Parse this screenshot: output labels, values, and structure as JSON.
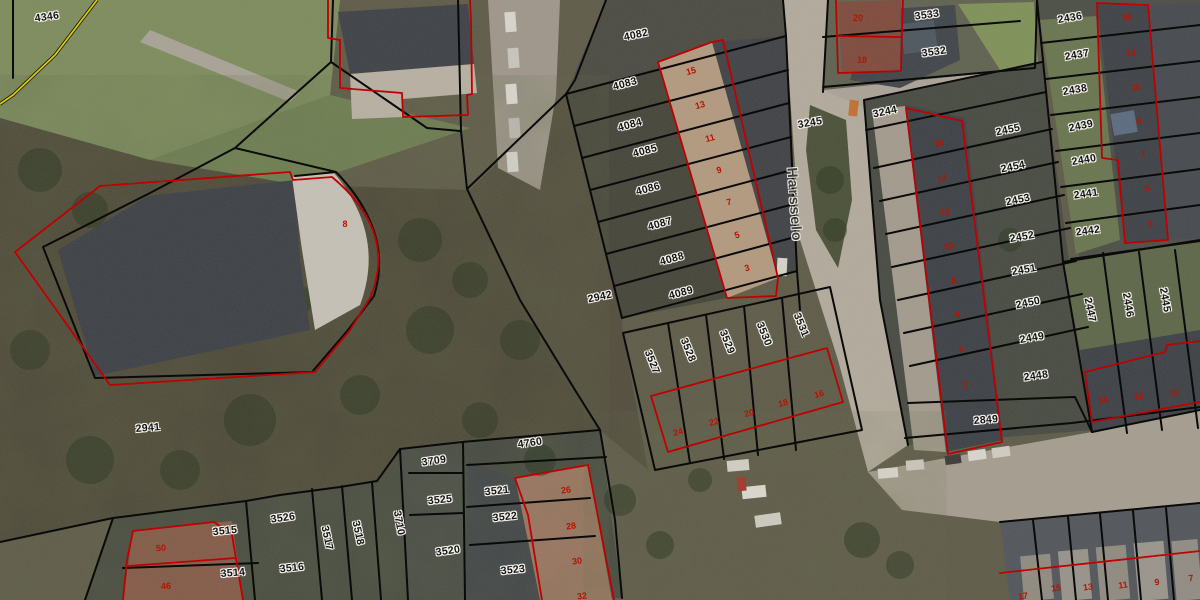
{
  "map": {
    "street_labels": [
      {
        "t": "Harsselo",
        "x": 795,
        "y": 205,
        "r": 86
      }
    ],
    "parcel_labels": [
      {
        "t": "4346",
        "x": 47,
        "y": 17,
        "r": -8
      },
      {
        "t": "4082",
        "x": 636,
        "y": 35,
        "r": -12
      },
      {
        "t": "4083",
        "x": 625,
        "y": 84,
        "r": -15
      },
      {
        "t": "4084",
        "x": 630,
        "y": 125,
        "r": -15
      },
      {
        "t": "4085",
        "x": 645,
        "y": 151,
        "r": -15
      },
      {
        "t": "4086",
        "x": 648,
        "y": 189,
        "r": -15
      },
      {
        "t": "4087",
        "x": 660,
        "y": 224,
        "r": -15
      },
      {
        "t": "4088",
        "x": 672,
        "y": 259,
        "r": -15
      },
      {
        "t": "4089",
        "x": 681,
        "y": 293,
        "r": -15
      },
      {
        "t": "2942",
        "x": 600,
        "y": 297,
        "r": -12
      },
      {
        "t": "2941",
        "x": 148,
        "y": 428,
        "r": -5
      },
      {
        "t": "3245",
        "x": 810,
        "y": 123,
        "r": -10
      },
      {
        "t": "3244",
        "x": 885,
        "y": 112,
        "r": -12
      },
      {
        "t": "3533",
        "x": 927,
        "y": 15,
        "r": -8
      },
      {
        "t": "3532",
        "x": 934,
        "y": 52,
        "r": -8
      },
      {
        "t": "2436",
        "x": 1070,
        "y": 18,
        "r": -10
      },
      {
        "t": "2437",
        "x": 1077,
        "y": 55,
        "r": -10
      },
      {
        "t": "2438",
        "x": 1075,
        "y": 90,
        "r": -10
      },
      {
        "t": "2439",
        "x": 1081,
        "y": 126,
        "r": -12
      },
      {
        "t": "2440",
        "x": 1084,
        "y": 160,
        "r": -10
      },
      {
        "t": "2441",
        "x": 1086,
        "y": 194,
        "r": -8
      },
      {
        "t": "2442",
        "x": 1088,
        "y": 231,
        "r": -8
      },
      {
        "t": "2455",
        "x": 1008,
        "y": 130,
        "r": -12
      },
      {
        "t": "2454",
        "x": 1013,
        "y": 167,
        "r": -12
      },
      {
        "t": "2453",
        "x": 1018,
        "y": 200,
        "r": -12
      },
      {
        "t": "2452",
        "x": 1022,
        "y": 237,
        "r": -10
      },
      {
        "t": "2451",
        "x": 1024,
        "y": 270,
        "r": -10
      },
      {
        "t": "2450",
        "x": 1028,
        "y": 303,
        "r": -12
      },
      {
        "t": "2449",
        "x": 1032,
        "y": 338,
        "r": -10
      },
      {
        "t": "2448",
        "x": 1036,
        "y": 376,
        "r": -8
      },
      {
        "t": "2849",
        "x": 986,
        "y": 420,
        "r": -5
      },
      {
        "t": "2447",
        "x": 1090,
        "y": 310,
        "r": 78
      },
      {
        "t": "2446",
        "x": 1128,
        "y": 305,
        "r": 80
      },
      {
        "t": "2445",
        "x": 1165,
        "y": 300,
        "r": 80
      },
      {
        "t": "3527",
        "x": 652,
        "y": 362,
        "r": 68
      },
      {
        "t": "3528",
        "x": 688,
        "y": 350,
        "r": 68
      },
      {
        "t": "3529",
        "x": 727,
        "y": 342,
        "r": 68
      },
      {
        "t": "3530",
        "x": 764,
        "y": 334,
        "r": 68
      },
      {
        "t": "3531",
        "x": 801,
        "y": 325,
        "r": 68
      },
      {
        "t": "4760",
        "x": 530,
        "y": 443,
        "r": -8
      },
      {
        "t": "3709",
        "x": 434,
        "y": 461,
        "r": -8
      },
      {
        "t": "3525",
        "x": 440,
        "y": 500,
        "r": -6
      },
      {
        "t": "3521",
        "x": 497,
        "y": 491,
        "r": -6
      },
      {
        "t": "3522",
        "x": 505,
        "y": 517,
        "r": -6
      },
      {
        "t": "3520",
        "x": 448,
        "y": 551,
        "r": -8
      },
      {
        "t": "3523",
        "x": 513,
        "y": 570,
        "r": -6
      },
      {
        "t": "3526",
        "x": 283,
        "y": 518,
        "r": -8
      },
      {
        "t": "3515",
        "x": 225,
        "y": 531,
        "r": -6
      },
      {
        "t": "3514",
        "x": 233,
        "y": 573,
        "r": -5
      },
      {
        "t": "3516",
        "x": 292,
        "y": 568,
        "r": -6
      },
      {
        "t": "3517",
        "x": 327,
        "y": 538,
        "r": 78
      },
      {
        "t": "3518",
        "x": 358,
        "y": 533,
        "r": 78
      },
      {
        "t": "3710",
        "x": 399,
        "y": 523,
        "r": 80
      }
    ],
    "house_number_labels": [
      {
        "t": "15",
        "x": 691,
        "y": 71,
        "r": -15
      },
      {
        "t": "13",
        "x": 700,
        "y": 105,
        "r": -15
      },
      {
        "t": "11",
        "x": 710,
        "y": 138,
        "r": -15
      },
      {
        "t": "9",
        "x": 719,
        "y": 170,
        "r": -15
      },
      {
        "t": "7",
        "x": 729,
        "y": 202,
        "r": -15
      },
      {
        "t": "5",
        "x": 737,
        "y": 235,
        "r": -15
      },
      {
        "t": "3",
        "x": 747,
        "y": 268,
        "r": -15
      },
      {
        "t": "20",
        "x": 858,
        "y": 18,
        "r": 0
      },
      {
        "t": "18",
        "x": 862,
        "y": 60,
        "r": 0
      },
      {
        "t": "16",
        "x": 939,
        "y": 143,
        "r": -10
      },
      {
        "t": "14",
        "x": 942,
        "y": 178,
        "r": -10
      },
      {
        "t": "12",
        "x": 945,
        "y": 212,
        "r": -10
      },
      {
        "t": "10",
        "x": 949,
        "y": 246,
        "r": -10
      },
      {
        "t": "8",
        "x": 954,
        "y": 281,
        "r": -10
      },
      {
        "t": "6",
        "x": 958,
        "y": 315,
        "r": -10
      },
      {
        "t": "4",
        "x": 961,
        "y": 349,
        "r": -10
      },
      {
        "t": "2",
        "x": 966,
        "y": 385,
        "r": -10
      },
      {
        "t": "15",
        "x": 1127,
        "y": 17,
        "r": -8
      },
      {
        "t": "13",
        "x": 1131,
        "y": 53,
        "r": -8
      },
      {
        "t": "11",
        "x": 1136,
        "y": 87,
        "r": -8
      },
      {
        "t": "9",
        "x": 1139,
        "y": 121,
        "r": -8
      },
      {
        "t": "7",
        "x": 1143,
        "y": 154,
        "r": -8
      },
      {
        "t": "5",
        "x": 1147,
        "y": 188,
        "r": -8
      },
      {
        "t": "3",
        "x": 1150,
        "y": 224,
        "r": -8
      },
      {
        "t": "24",
        "x": 678,
        "y": 432,
        "r": -15
      },
      {
        "t": "22",
        "x": 714,
        "y": 422,
        "r": -15
      },
      {
        "t": "20",
        "x": 749,
        "y": 413,
        "r": -15
      },
      {
        "t": "18",
        "x": 783,
        "y": 403,
        "r": -15
      },
      {
        "t": "16",
        "x": 819,
        "y": 394,
        "r": -15
      },
      {
        "t": "14",
        "x": 1103,
        "y": 400,
        "r": -8
      },
      {
        "t": "12",
        "x": 1139,
        "y": 396,
        "r": -8
      },
      {
        "t": "10",
        "x": 1174,
        "y": 393,
        "r": -8
      },
      {
        "t": "26",
        "x": 566,
        "y": 490,
        "r": -8
      },
      {
        "t": "28",
        "x": 571,
        "y": 526,
        "r": -8
      },
      {
        "t": "30",
        "x": 577,
        "y": 561,
        "r": -8
      },
      {
        "t": "32",
        "x": 582,
        "y": 596,
        "r": -8
      },
      {
        "t": "50",
        "x": 161,
        "y": 548,
        "r": -5
      },
      {
        "t": "46",
        "x": 166,
        "y": 586,
        "r": -5
      },
      {
        "t": "8",
        "x": 345,
        "y": 224,
        "r": 0
      },
      {
        "t": "17",
        "x": 1023,
        "y": 596,
        "r": -8
      },
      {
        "t": "15",
        "x": 1056,
        "y": 588,
        "r": -8
      },
      {
        "t": "13",
        "x": 1088,
        "y": 587,
        "r": -8
      },
      {
        "t": "11",
        "x": 1123,
        "y": 585,
        "r": -8
      },
      {
        "t": "9",
        "x": 1157,
        "y": 582,
        "r": -8
      },
      {
        "t": "7",
        "x": 1191,
        "y": 578,
        "r": -8
      }
    ],
    "colors": {
      "parcel_line": "#0a0a0a",
      "building_line": "#c00000",
      "parcel_label_text": "#141414",
      "house_number_text": "#b51500",
      "boundary_yellow": "#d9cb00"
    }
  }
}
